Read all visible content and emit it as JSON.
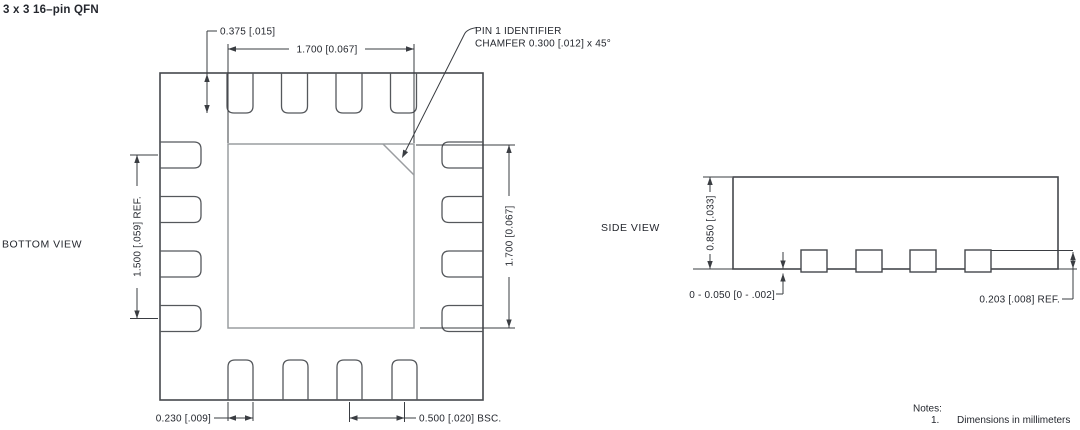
{
  "title": "3 x 3 16–pin QFN",
  "bottom_view": {
    "label": "BOTTOM VIEW",
    "pin1_callout": {
      "line1": "PIN 1 IDENTIFIER",
      "line2": "CHAMFER 0.300 [.012] x 45°"
    },
    "dimensions": {
      "terminal_length": "0.375 [.015]",
      "pad_width": "1.700 [0.067]",
      "pad_height": "1.700 [0.067]",
      "terminal_span": "1.500 [.059] REF.",
      "terminal_width": "0.230 [.009]",
      "pitch": "0.500 [.020] BSC."
    }
  },
  "side_view": {
    "label": "SIDE VIEW",
    "dimensions": {
      "body_height": "0.850 [.033]",
      "standoff": "0 - 0.050 [0 - .002]",
      "lead_thickness": "0.203 [.008] REF."
    }
  },
  "notes": {
    "heading": "Notes:",
    "items": [
      {
        "number": "1.",
        "text": "Dimensions in millimeters"
      }
    ]
  },
  "colors": {
    "background": "#ffffff",
    "line_dark": "#45484c",
    "line_pad_gray": "#9a9da0",
    "dimension_line": "#3a3d42",
    "text": "#24272e"
  }
}
